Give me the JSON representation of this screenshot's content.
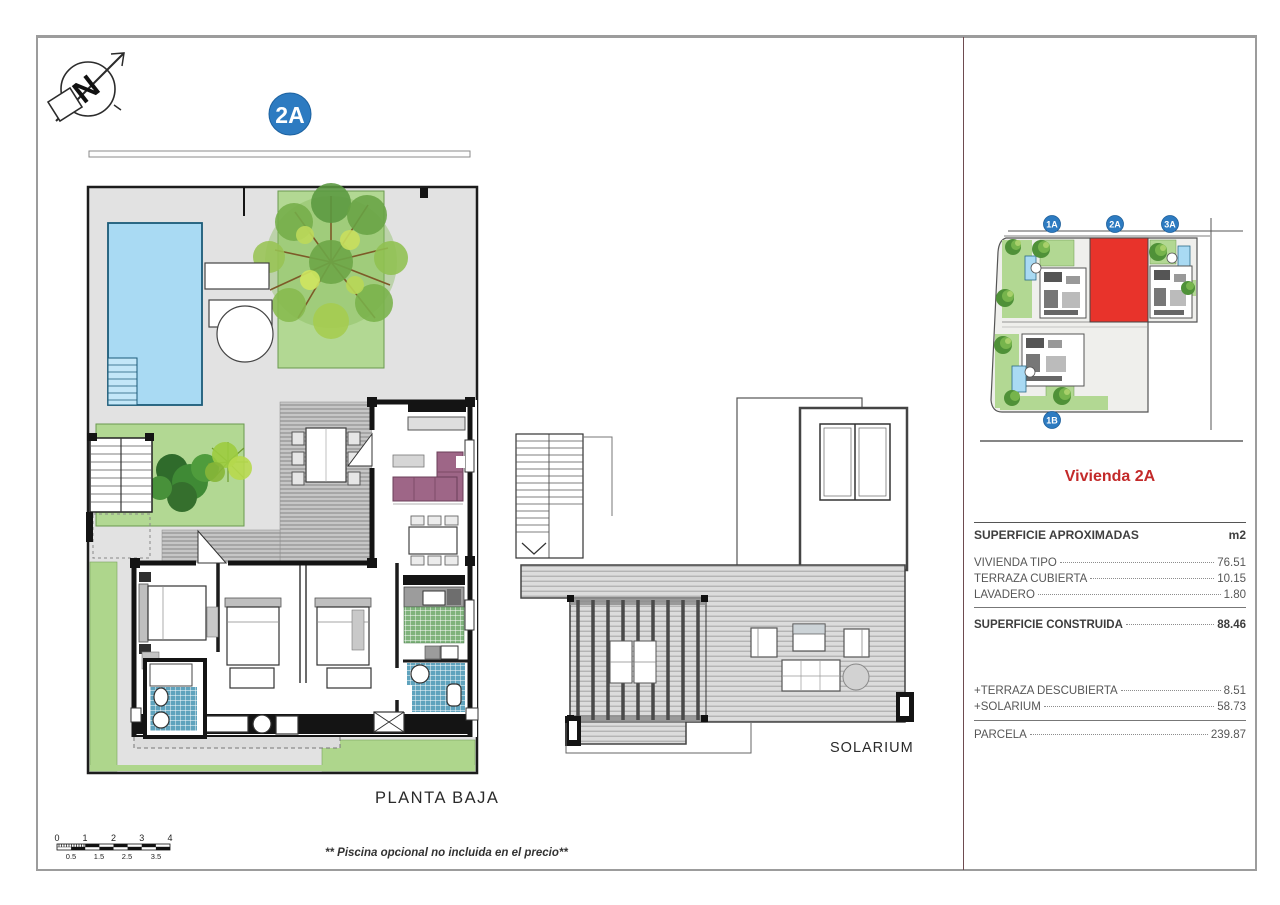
{
  "page": {
    "badge_label": "2A",
    "plan_label": "PLANTA BAJA",
    "solarium_label": "SOLARIUM",
    "footnote": "** Piscina opcional no incluida en el precio**",
    "compass_letter": "N"
  },
  "site_plan": {
    "badges": [
      {
        "label": "1A"
      },
      {
        "label": "2A"
      },
      {
        "label": "3A"
      },
      {
        "label": "1B"
      }
    ],
    "badge_color": "#2d7bc1",
    "highlight_color": "#e8332b"
  },
  "panel": {
    "title": "Vivienda 2A",
    "title_color": "#c32a2a",
    "header": {
      "label": "SUPERFICIE APROXIMADAS",
      "unit": "m2"
    },
    "rows": [
      {
        "label": "VIVIENDA TIPO",
        "value": "76.51"
      },
      {
        "label": "TERRAZA CUBIERTA",
        "value": "10.15"
      },
      {
        "label": "LAVADERO",
        "value": "1.80"
      }
    ],
    "total": {
      "label": "SUPERFICIE CONSTRUIDA",
      "value": "88.46"
    },
    "extras": [
      {
        "label": "+TERRAZA DESCUBIERTA",
        "value": "8.51"
      },
      {
        "label": "+SOLARIUM",
        "value": "58.73"
      }
    ],
    "parcela": {
      "label": "PARCELA",
      "value": "239.87"
    }
  },
  "scale_bar": {
    "top_labels": [
      "0",
      "1",
      "2",
      "3",
      "4"
    ],
    "bottom_labels": [
      "0.5",
      "1.5",
      "2.5",
      "3.5"
    ]
  }
}
